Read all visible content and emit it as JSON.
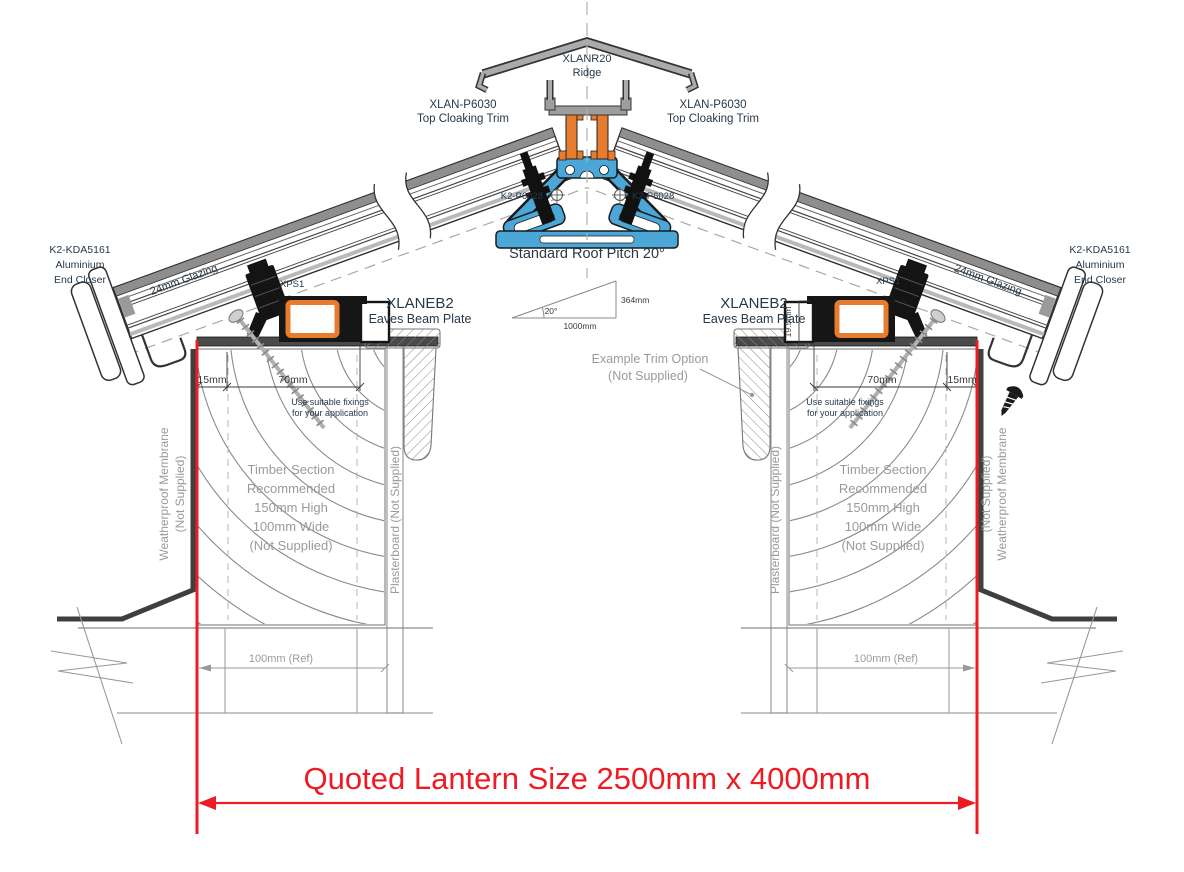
{
  "d": {
    "ridge_model": "XLANR20",
    "ridge_label": "Ridge",
    "cloak_model": "XLAN-P6030",
    "cloak_label": "Top Cloaking Trim",
    "bolt_model": "K2-P6028",
    "pitch_title": "Standard Roof Pitch 20°",
    "pitch_angle": "20°",
    "pitch_run": "1000mm",
    "pitch_rise": "364mm",
    "endcloser_model": "K2-KDA5161",
    "endcloser_l2": "Aluminium",
    "endcloser_l3": "End Closer",
    "glazing_label": "24mm Glazing",
    "xps_label": "XPS1",
    "eaves_model": "XLANEB2",
    "eaves_label": "Eaves Beam Plate",
    "dim_15": "15mm",
    "dim_70": "70mm",
    "dim_195": "19.5mm",
    "dim_ref": "100mm (Ref)",
    "fix_l1": "Use suitable fixings",
    "fix_l2": "for your application",
    "timber_l1": "Timber Section",
    "timber_l2": "Recommended",
    "timber_l3": "150mm High",
    "timber_l4": "100mm Wide",
    "timber_l5": "(Not Supplied)",
    "membrane_l1": "Weatherproof Membrane",
    "membrane_l2": "(Not Supplied)",
    "plasterboard": "Plasterboard (Not Supplied)",
    "trim_l1": "Example  Trim Option",
    "trim_l2": "(Not Supplied)",
    "quoted": "Quoted Lantern Size 2500mm x 4000mm",
    "colors": {
      "red": "#ed1c24",
      "blue": "#4aa7d8",
      "orange": "#e87c2e",
      "frame_dark": "#161616"
    }
  }
}
